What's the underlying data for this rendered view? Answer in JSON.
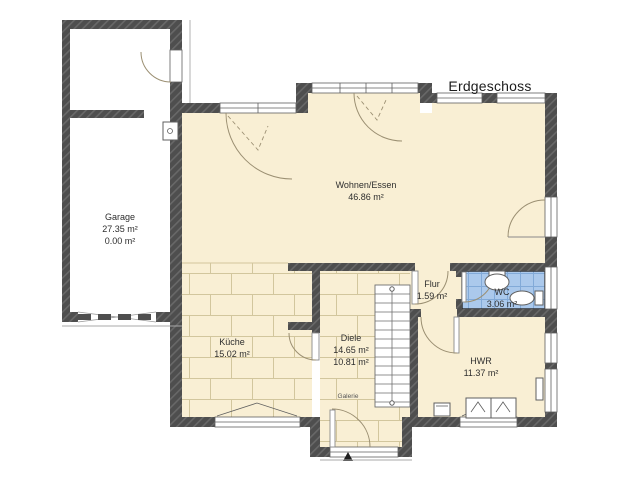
{
  "title": "Erdgeschoss",
  "rooms": {
    "garage": {
      "name": "Garage",
      "line2": "27.35 m²",
      "line3": "0.00 m²"
    },
    "wohnen_essen": {
      "name": "Wohnen/Essen",
      "line2": "46.86 m²"
    },
    "kueche": {
      "name": "Küche",
      "line2": "15.02 m²"
    },
    "diele": {
      "name": "Diele",
      "line2": "14.65 m²",
      "line3": "10.81 m²"
    },
    "flur": {
      "name": "Flur",
      "line2": "1.59 m²"
    },
    "wc": {
      "name": "WC",
      "line2": "3.06 m²"
    },
    "hwr": {
      "name": "HWR",
      "line2": "11.37 m²"
    },
    "galerie": {
      "name": "Galerie"
    }
  },
  "colors": {
    "wall": "#4e4e4e",
    "wall_hatch": "#686868",
    "floor_cream": "#f9efd4",
    "tile_line": "#d2c69d",
    "wc_fill": "#abc9ec",
    "wc_tile_line": "#82aad8",
    "garage_floor": "#ffffff",
    "door_arc": "#9b8f72",
    "text": "#2e2e2e"
  }
}
